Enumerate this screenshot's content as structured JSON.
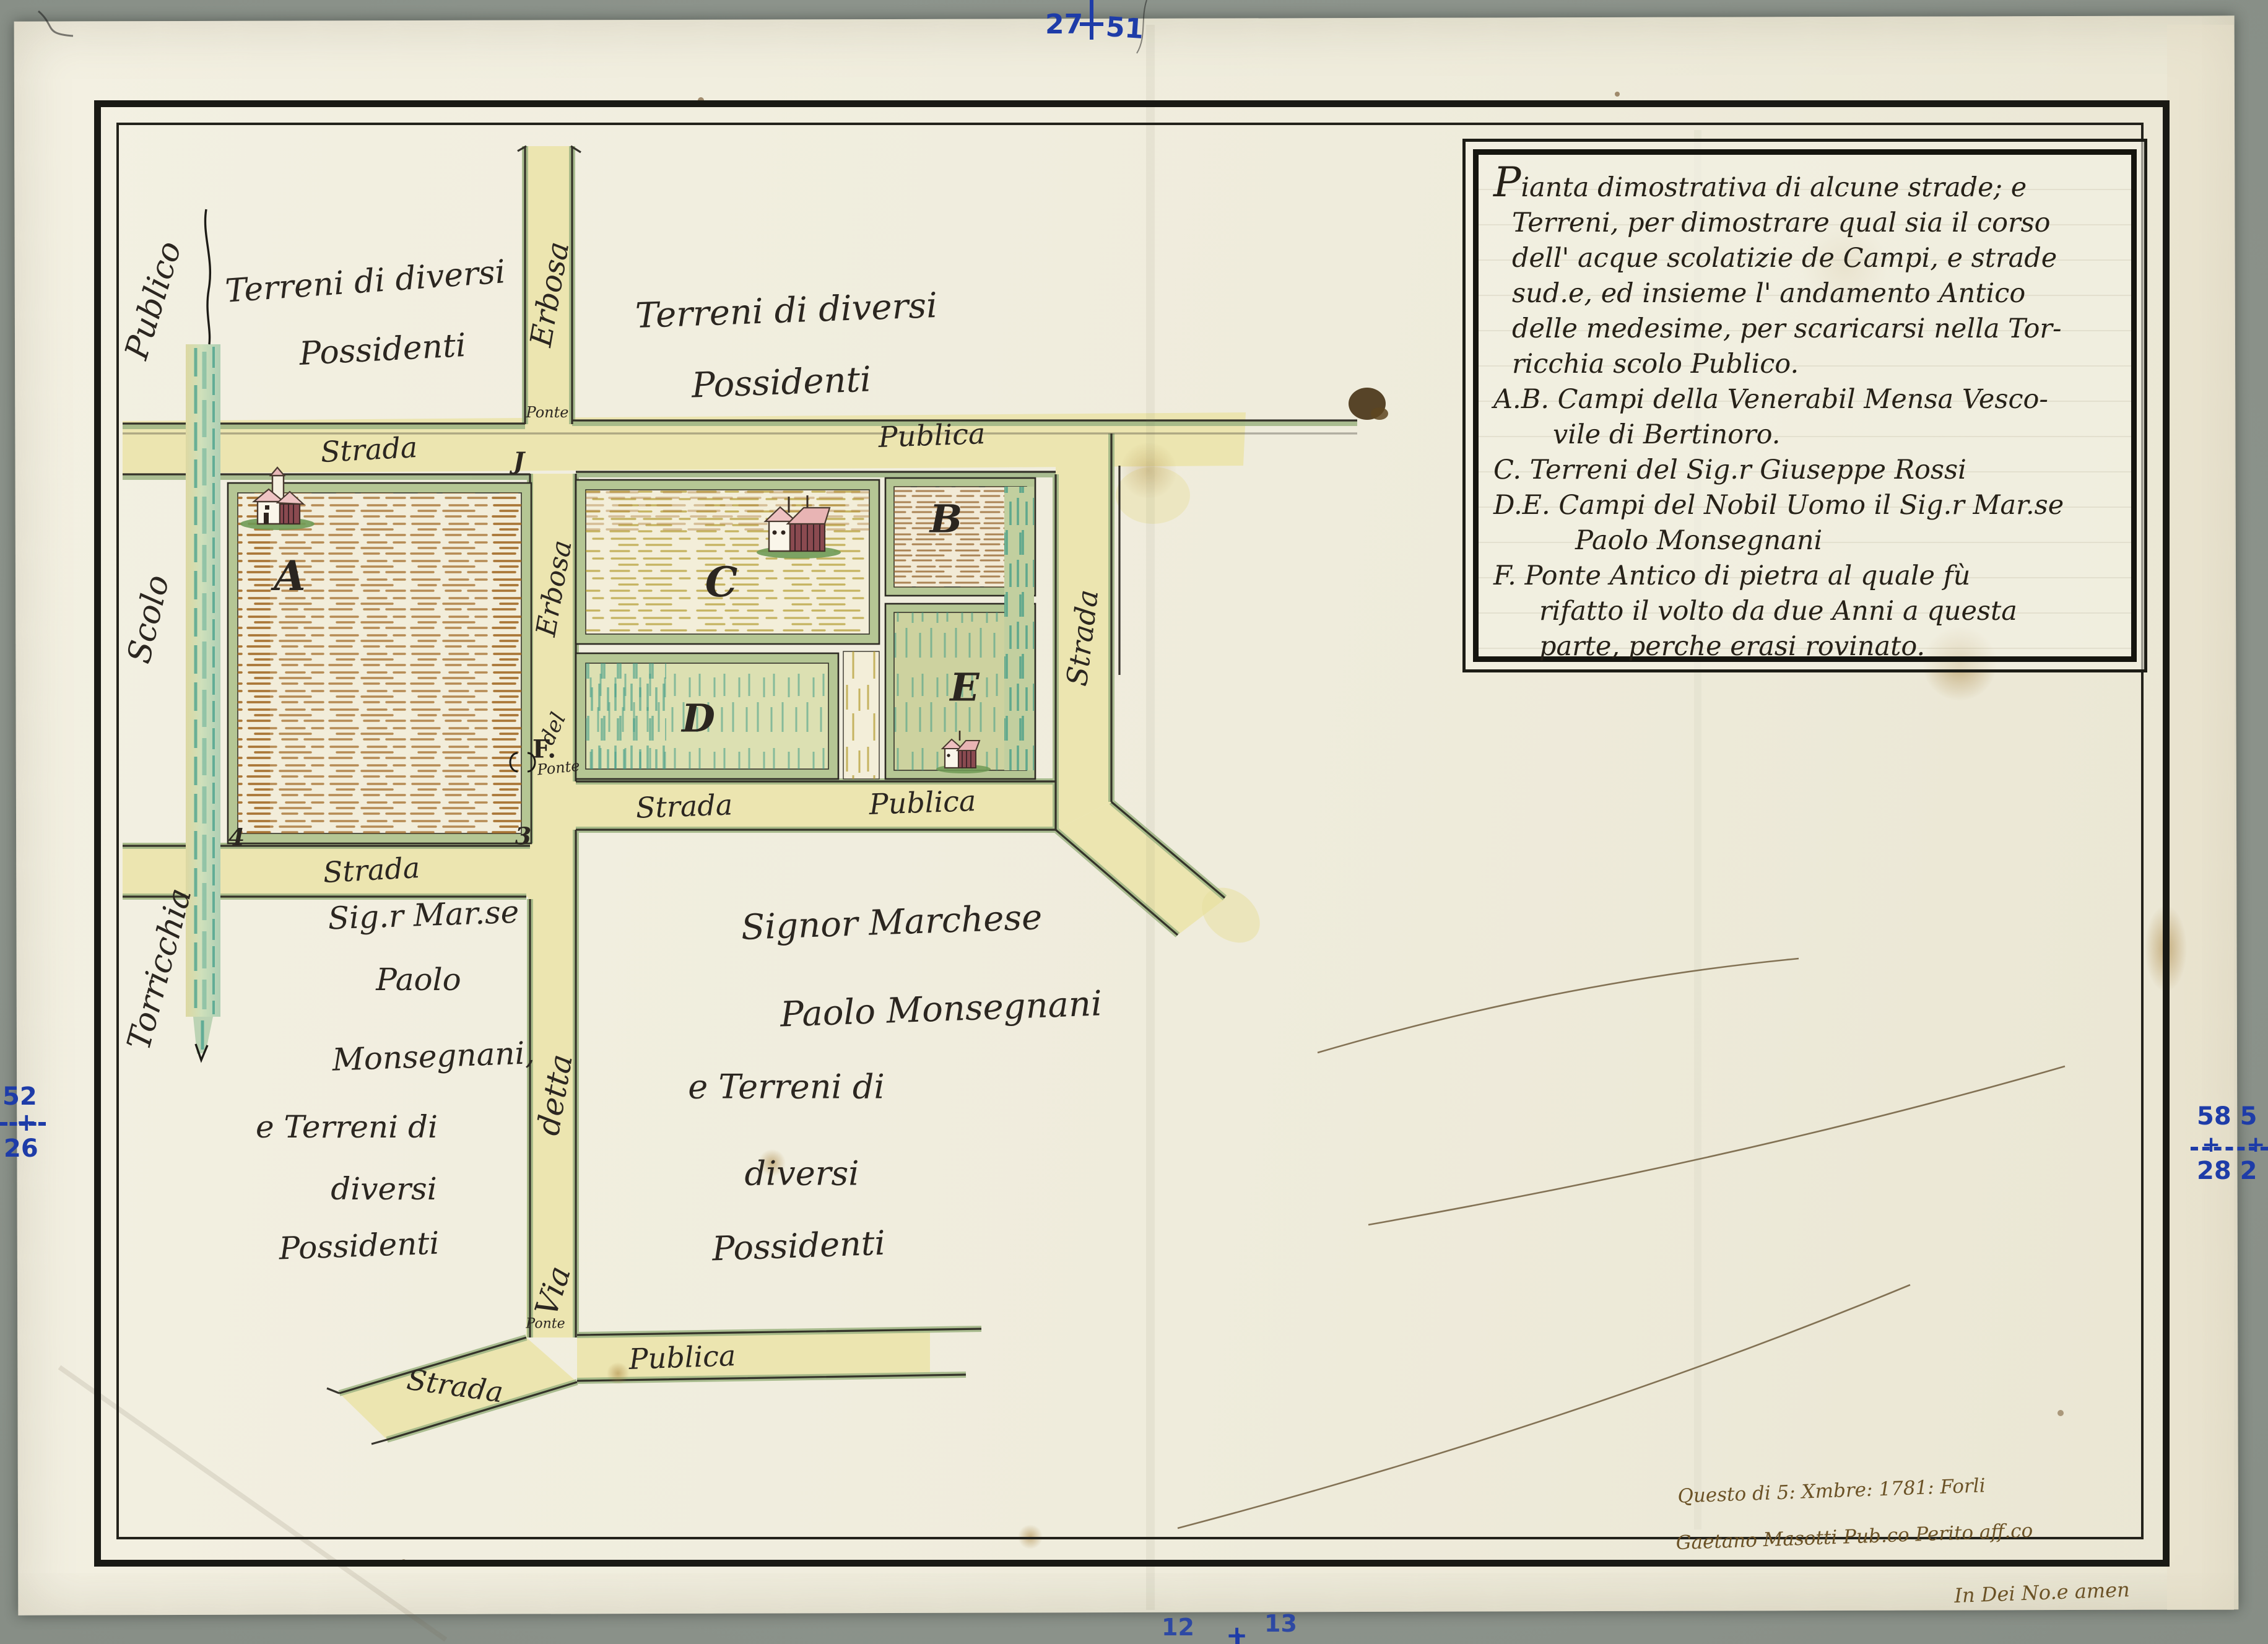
{
  "document": {
    "type": "manuscript-cadastral-map",
    "date_shown": "1781",
    "place_shown": "Forli"
  },
  "legend": {
    "lines": [
      "Pianta dimostrativa di alcune strade; e",
      "Terreni, per dimostrare qual sia il corso",
      "dell' acque scolatizie de Campi, e strade",
      "sud.e, ed insieme l' andamento Antico",
      "delle medesime, per scaricarsi nella Tor-",
      "ricchia scolo Publico.",
      "A.B. Campi della Venerabil Mensa Vesco-",
      "vile di Bertinoro.",
      "C. Terreni del Sig.r Giuseppe Rossi",
      "D.E. Campi del Nobil Uomo il Sig.r Mar.se",
      "Paolo Monsegnani",
      "F. Ponte Antico di pietra al quale fù",
      "rifatto il volto da due Anni a questa",
      "parte, perche erasi rovinato."
    ]
  },
  "map": {
    "labels": {
      "publico": "Publico",
      "scolo": "Scolo",
      "torricchia": "Torricchia",
      "terreni_nw_1": "Terreni di diversi",
      "terreni_nw_2": "Possidenti",
      "terreni_top_1": "Terreni di diversi",
      "terreni_top_2": "Possidenti",
      "strada_top": "Strada",
      "publica_top": "Publica",
      "erbosa_top": "Erbosa",
      "ponte_top": "Ponte",
      "erbosa_mid": "Erbosa",
      "del": "del",
      "f": "F.",
      "ponte_f": "Ponte",
      "strada_below_a": "Strada",
      "strada_mid": "Strada",
      "publica_mid": "Publica",
      "strada_right": "Strada",
      "detta": "detta",
      "via": "Via",
      "ponte_bottom": "Ponte",
      "strada_bottom": "Strada",
      "publica_bottom": "Publica",
      "marker_1": "J",
      "marker_3": "3",
      "marker_4": "4"
    },
    "parcels": {
      "a": "A",
      "b": "B",
      "c": "C",
      "d": "D",
      "e": "E"
    },
    "owner_left": {
      "lines": [
        "Sig.r Mar.se",
        "Paolo",
        "Monsegnani,",
        "e Terreni di",
        "diversi",
        "Possidenti"
      ]
    },
    "owner_center": {
      "lines": [
        "Signor Marchese",
        "Paolo Monsegnani",
        "e Terreni di",
        "diversi",
        "Possidenti"
      ]
    },
    "signature": {
      "line1": "Questo di 5: Xmbre: 1781: Forli",
      "line2": "Gaetano Masotti Pub.co Perito aff.co"
    },
    "note_below_border": "In Dei No.e amen"
  },
  "scan_marks": {
    "top_left_num": "27",
    "top_right_num": "51",
    "left_top_num": "52",
    "left_bottom_num": "26",
    "right_top_num": "58 5",
    "right_bottom_num": "28 2",
    "bottom_left_num": "12",
    "bottom_right_num": "13"
  },
  "colors": {
    "scanner_bg": "#8d948c",
    "paper": "#f1eee0",
    "road_yellow": "#ece5b0",
    "parcel_band_green": "#b5c694",
    "canal_teal": "#3f9a86",
    "hatch_brown": "#a5712f",
    "hatch_olive": "#b29a2c",
    "ink_black": "#2b2620",
    "ink_brown": "#6b5226",
    "mark_blue": "#1e3ca8"
  }
}
